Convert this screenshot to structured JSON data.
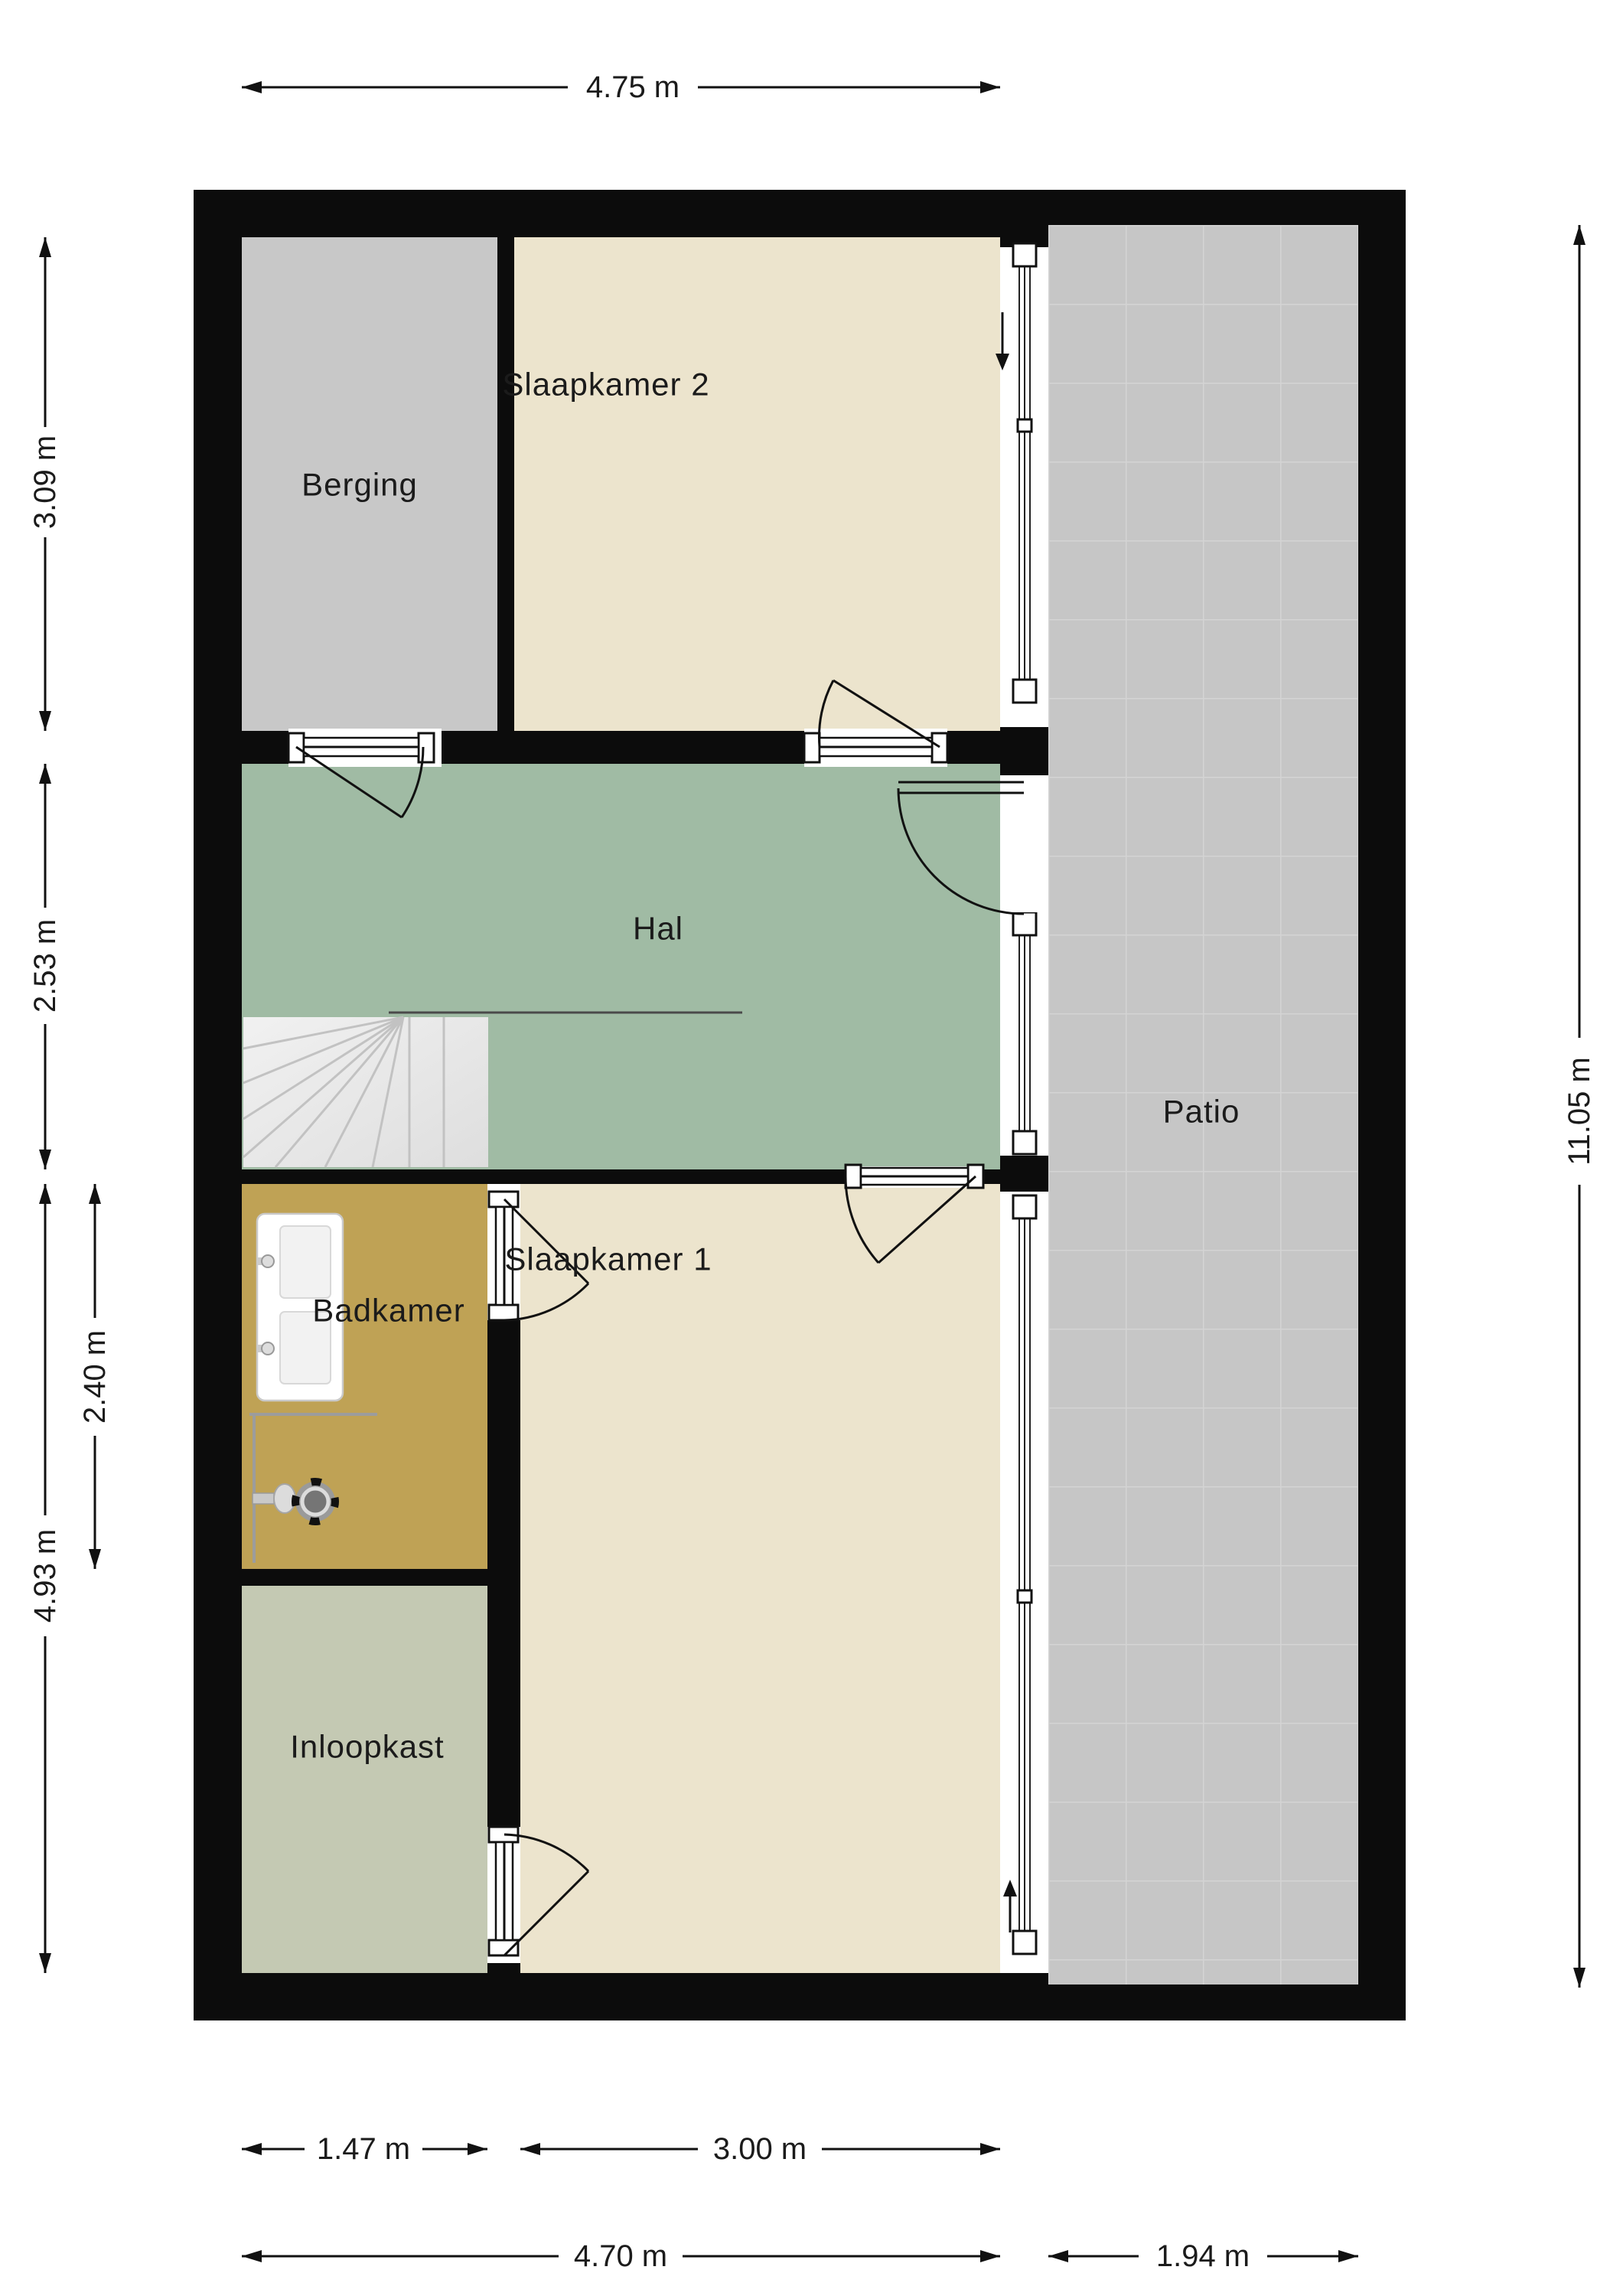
{
  "rooms": {
    "berging": "Berging",
    "slaapkamer2": "Slaapkamer 2",
    "hal": "Hal",
    "badkamer": "Badkamer",
    "slaapkamer1": "Slaapkamer 1",
    "inloopkast": "Inloopkast",
    "patio": "Patio"
  },
  "dimensions": {
    "top_width": "4.75 m",
    "berging_height": "3.09 m",
    "hal_height": "2.53 m",
    "badkamer_height": "2.40 m",
    "lower_left_height": "4.93 m",
    "total_height": "11.05 m",
    "inloopkast_width": "1.47 m",
    "slaapkamer1_width": "3.00 m",
    "main_width": "4.70 m",
    "patio_width": "1.94 m"
  },
  "colors": {
    "wall": "#0c0c0c",
    "berging": "#c8c8c8",
    "bedroom": "#ece4cd",
    "hal": "#a0bba4",
    "badkamer": "#bfa255",
    "inloopkast": "#c4c9b3",
    "patio": "#c6c6c6",
    "stairs": "#e7e7e7",
    "dimension_text": "#1b1b1b"
  }
}
